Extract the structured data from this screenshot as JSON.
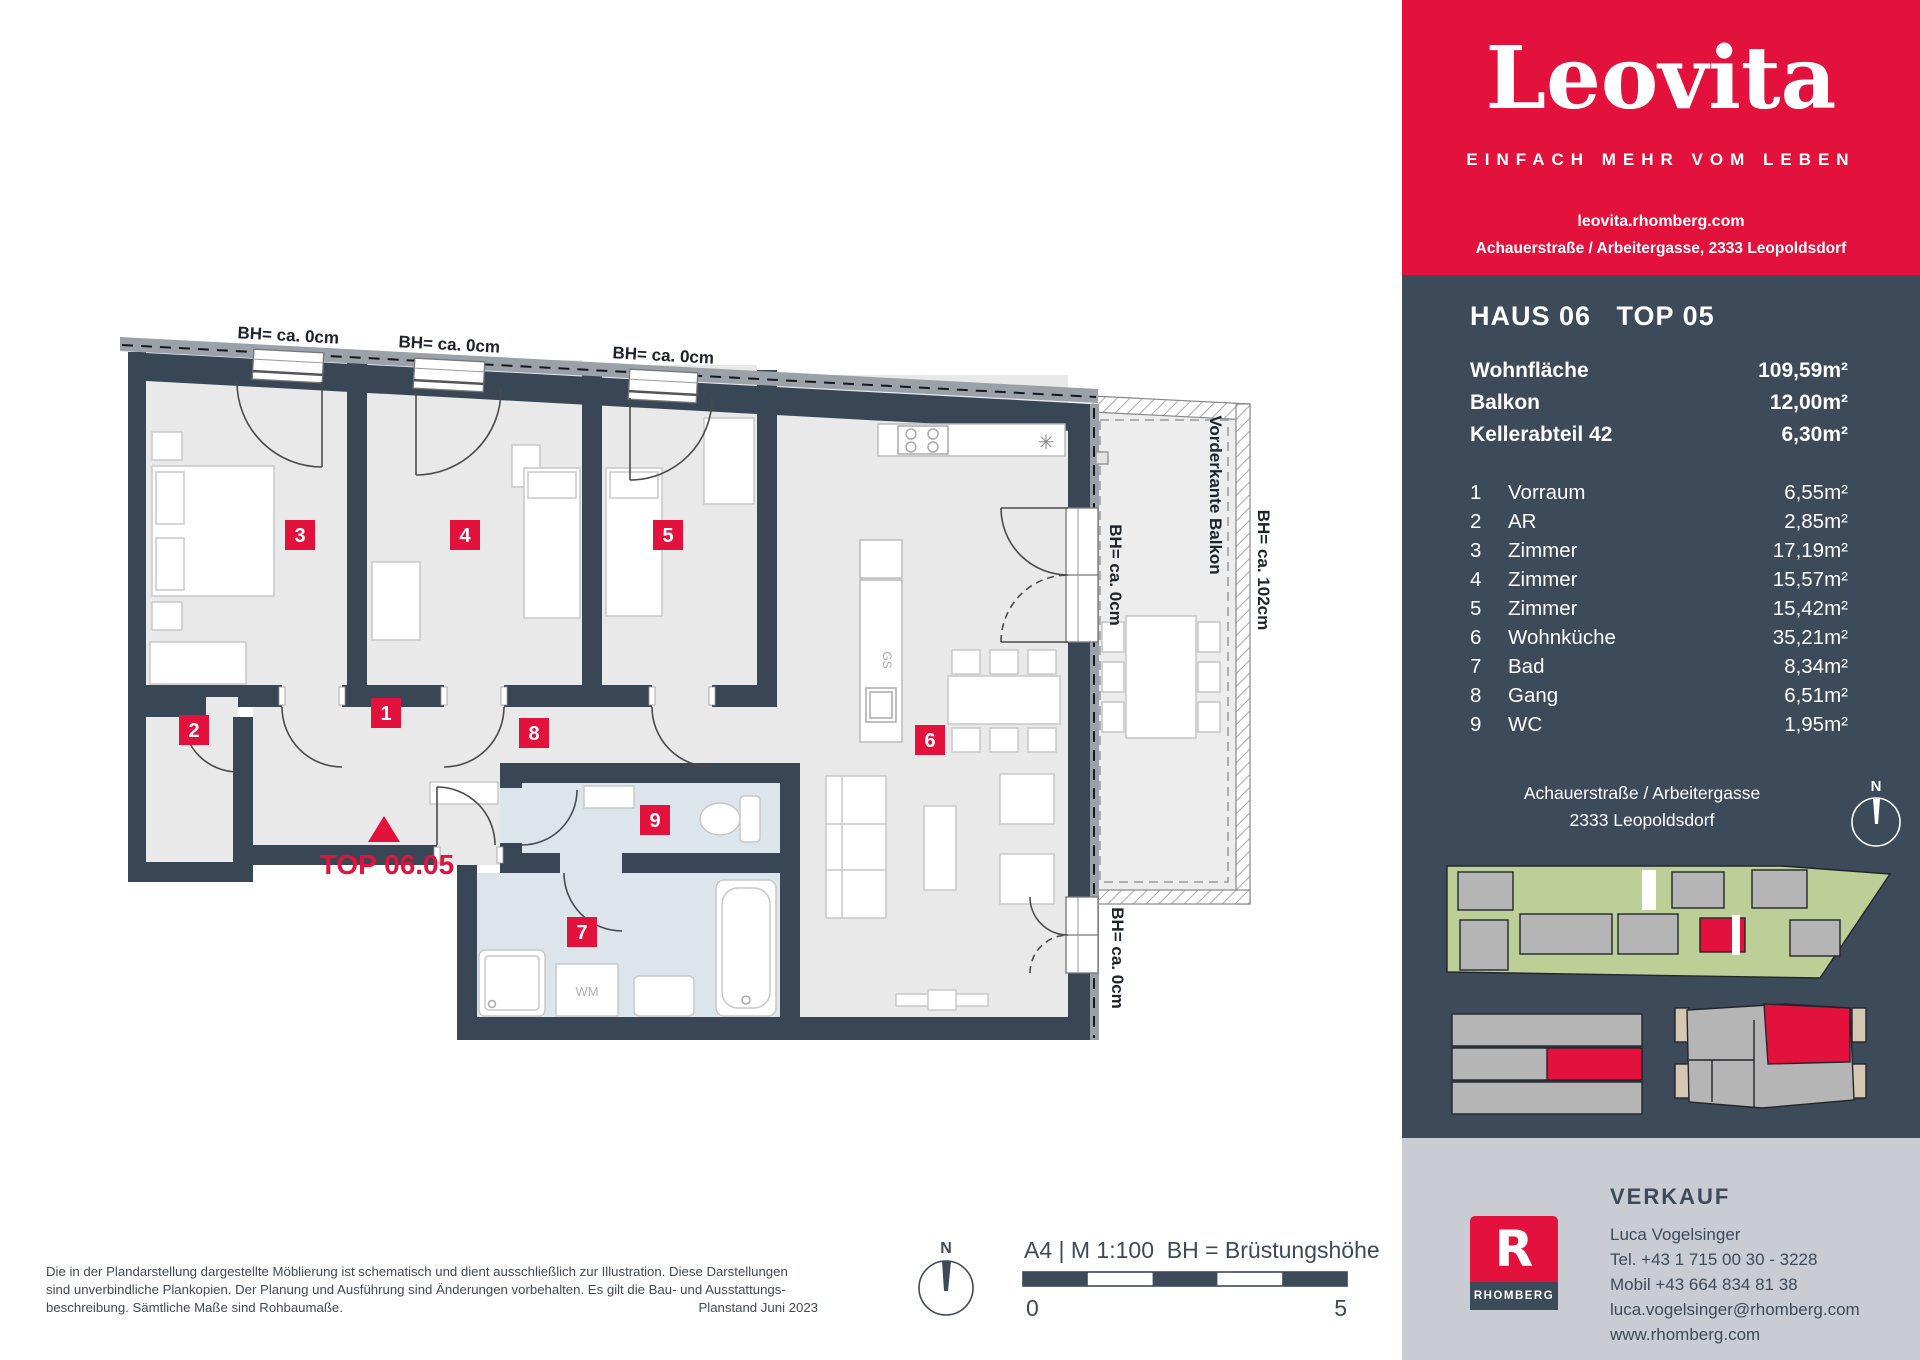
{
  "brand": {
    "logo": "Leovita",
    "tagline": "EINFACH MEHR VOM LEBEN",
    "website": "leovita.rhomberg.com",
    "address_line": "Achauerstraße / Arbeitergasse, 2333 Leopoldsdorf",
    "accent_red": "#e2123d",
    "navy": "#3d4a5a"
  },
  "unit": {
    "title": "HAUS 06   TOP 05",
    "summary": [
      {
        "label": "Wohnfläche",
        "value": "109,59m²"
      },
      {
        "label": "Balkon",
        "value": "12,00m²"
      },
      {
        "label": "Kellerabteil 42",
        "value": "6,30m²"
      }
    ],
    "rooms": [
      {
        "no": "1",
        "name": "Vorraum",
        "area": "6,55m²"
      },
      {
        "no": "2",
        "name": "AR",
        "area": "2,85m²"
      },
      {
        "no": "3",
        "name": "Zimmer",
        "area": "17,19m²"
      },
      {
        "no": "4",
        "name": "Zimmer",
        "area": "15,57m²"
      },
      {
        "no": "5",
        "name": "Zimmer",
        "area": "15,42m²"
      },
      {
        "no": "6",
        "name": "Wohnküche",
        "area": "35,21m²"
      },
      {
        "no": "7",
        "name": "Bad",
        "area": "8,34m²"
      },
      {
        "no": "8",
        "name": "Gang",
        "area": "6,51m²"
      },
      {
        "no": "9",
        "name": "WC",
        "area": "1,95m²"
      }
    ]
  },
  "location": {
    "street": "Achauerstraße / Arbeitergasse",
    "city": "2333 Leopoldsdorf",
    "compass": "N"
  },
  "plan": {
    "entrance_label": "TOP 06.05",
    "window_labels": [
      "BH= ca. 0cm",
      "BH= ca. 0cm",
      "BH= ca. 0cm"
    ],
    "balcony_front_label": "Vorderkante Balkon",
    "balcony_rail_label": "BH= ca. 102cm",
    "balcony_door_label_upper": "BH= ca. 0cm",
    "balcony_door_label_lower": "BH= ca. 0cm",
    "room_numbers": [
      "1",
      "2",
      "3",
      "4",
      "5",
      "6",
      "7",
      "8",
      "9"
    ],
    "appliances": {
      "dishwasher": "GS",
      "washing_machine": "WM",
      "sink_symbol": "✳"
    }
  },
  "footer_plan": {
    "scale_title": "A4 | M 1:100  BH = Brüstungshöhe",
    "scale_start": "0",
    "scale_end": "5",
    "north": "N",
    "disclaimer_lines": [
      "Die in der Plandarstellung dargestellte Möblierung ist schematisch und dient ausschließlich zur Illustration. Diese Darstellungen",
      "sind unverbindliche Plankopien. Der Planung und Ausführung sind Änderungen vorbehalten. Es gilt die Bau- und Ausstattungs-",
      "beschreibung. Sämtliche Maße sind Rohbaumaße."
    ],
    "plan_date": "Planstand Juni 2023"
  },
  "sales": {
    "heading": "VERKAUF",
    "name": "Luca Vogelsinger",
    "tel": "Tel. +43 1 715 00 30 - 3228",
    "mobile": "Mobil +43 664 834 81 38",
    "email": "luca.vogelsinger@rhomberg.com",
    "web": "www.rhomberg.com",
    "logo_letter": "R",
    "logo_name": "RHOMBERG"
  }
}
